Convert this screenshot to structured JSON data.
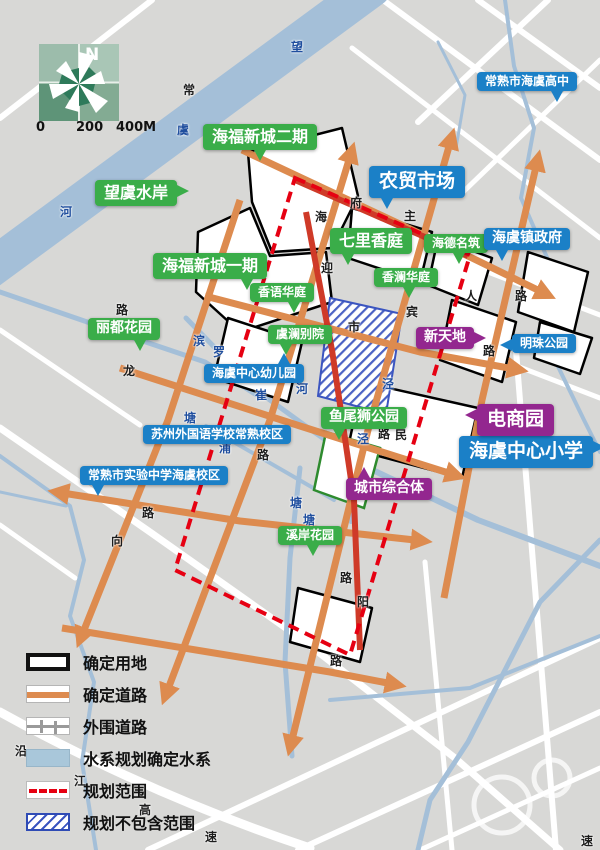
{
  "compass": {
    "north_label": "N"
  },
  "scale_bar": {
    "ticks": [
      "0",
      "200",
      "400M"
    ]
  },
  "colors": {
    "label_green": "#3aad49",
    "label_blue": "#1b80c7",
    "label_purple": "#93278f",
    "confirmed_road_orange": "#dd8b4f",
    "red_road": "#cf3a28",
    "planning_boundary_red": "#e60012",
    "water_blue": "#a4bfd8",
    "background_gray": "#d8d8d6",
    "hatch_blue": "#3b55c0"
  },
  "map_labels": [
    {
      "text": "海福新城二期",
      "color": "green",
      "x": 203,
      "y": 124,
      "size": "l",
      "tail": "b"
    },
    {
      "text": "望虞水岸",
      "color": "green",
      "x": 95,
      "y": 180,
      "size": "l",
      "tail": "r"
    },
    {
      "text": "海福新城一期",
      "color": "green",
      "x": 153,
      "y": 253,
      "size": "l",
      "tail": "br"
    },
    {
      "text": "七里香庭",
      "color": "green",
      "x": 330,
      "y": 228,
      "size": "l",
      "tail": "bl"
    },
    {
      "text": "海德名筑",
      "color": "green",
      "x": 424,
      "y": 234,
      "size": "s",
      "tail": "b"
    },
    {
      "text": "香语华庭",
      "color": "green",
      "x": 250,
      "y": 283,
      "size": "s",
      "tail": "br"
    },
    {
      "text": "香澜华庭",
      "color": "green",
      "x": 374,
      "y": 268,
      "size": "s",
      "tail": "b"
    },
    {
      "text": "丽都花园",
      "color": "green",
      "x": 88,
      "y": 318,
      "size": "m",
      "tail": "br"
    },
    {
      "text": "虞澜别院",
      "color": "green",
      "x": 268,
      "y": 325,
      "size": "s",
      "tail": "bl"
    },
    {
      "text": "鱼尾狮公园",
      "color": "green",
      "x": 321,
      "y": 407,
      "size": "m",
      "tail": "bl"
    },
    {
      "text": "溪岸花园",
      "color": "green",
      "x": 278,
      "y": 526,
      "size": "s",
      "tail": "b"
    },
    {
      "text": "常熟市海虞高中",
      "color": "blue",
      "x": 477,
      "y": 72,
      "size": "s",
      "tail": "br"
    },
    {
      "text": "农贸市场",
      "color": "blue",
      "x": 369,
      "y": 166,
      "size": "xl",
      "tail": "bl"
    },
    {
      "text": "海虞镇政府",
      "color": "blue",
      "x": 484,
      "y": 228,
      "size": "m",
      "tail": "bl"
    },
    {
      "text": "明珠公园",
      "color": "blue",
      "x": 512,
      "y": 334,
      "size": "s",
      "tail": "l"
    },
    {
      "text": "海虞中心幼儿园",
      "color": "blue",
      "x": 204,
      "y": 364,
      "size": "s",
      "tail": "tr"
    },
    {
      "text": "苏州外国语学校常熟校区",
      "color": "blue",
      "x": 143,
      "y": 425,
      "size": "s",
      "tail": "none"
    },
    {
      "text": "常熟市实验中学海虞校区",
      "color": "blue",
      "x": 80,
      "y": 466,
      "size": "s",
      "tail": "bl"
    },
    {
      "text": "海虞中心小学",
      "color": "blue",
      "x": 459,
      "y": 436,
      "size": "xl",
      "tail": "r"
    },
    {
      "text": "新天地",
      "color": "purple",
      "x": 416,
      "y": 327,
      "size": "m",
      "tail": "r"
    },
    {
      "text": "电商园",
      "color": "purple",
      "x": 477,
      "y": 404,
      "size": "xl",
      "tail": "l"
    },
    {
      "text": "城市综合体",
      "color": "purple",
      "x": 346,
      "y": 478,
      "size": "m",
      "tail": "tl"
    }
  ],
  "road_names": [
    {
      "text": "望",
      "x": 291,
      "y": 41,
      "tone": "blue"
    },
    {
      "text": "常",
      "x": 183,
      "y": 84,
      "tone": "dark"
    },
    {
      "text": "虞",
      "x": 177,
      "y": 124,
      "tone": "blue"
    },
    {
      "text": "河",
      "x": 60,
      "y": 206,
      "tone": "blue"
    },
    {
      "text": "府",
      "x": 350,
      "y": 197,
      "tone": "dark"
    },
    {
      "text": "主",
      "x": 404,
      "y": 210,
      "tone": "dark"
    },
    {
      "text": "海",
      "x": 315,
      "y": 211,
      "tone": "dark"
    },
    {
      "text": "迎",
      "x": 321,
      "y": 262,
      "tone": "dark"
    },
    {
      "text": "宾",
      "x": 406,
      "y": 306,
      "tone": "dark"
    },
    {
      "text": "人",
      "x": 465,
      "y": 290,
      "tone": "dark"
    },
    {
      "text": "路",
      "x": 515,
      "y": 290,
      "tone": "dark"
    },
    {
      "text": "市",
      "x": 348,
      "y": 321,
      "tone": "dark"
    },
    {
      "text": "滨",
      "x": 193,
      "y": 335,
      "tone": "blue"
    },
    {
      "text": "罗",
      "x": 213,
      "y": 346,
      "tone": "blue"
    },
    {
      "text": "崔",
      "x": 255,
      "y": 389,
      "tone": "blue"
    },
    {
      "text": "河",
      "x": 296,
      "y": 383,
      "tone": "blue"
    },
    {
      "text": "泾",
      "x": 382,
      "y": 378,
      "tone": "blue"
    },
    {
      "text": "塘",
      "x": 184,
      "y": 412,
      "tone": "blue"
    },
    {
      "text": "路",
      "x": 116,
      "y": 304,
      "tone": "dark"
    },
    {
      "text": "龙",
      "x": 123,
      "y": 365,
      "tone": "dark"
    },
    {
      "text": "浦",
      "x": 219,
      "y": 442,
      "tone": "blue"
    },
    {
      "text": "路",
      "x": 257,
      "y": 449,
      "tone": "dark"
    },
    {
      "text": "泾",
      "x": 357,
      "y": 433,
      "tone": "blue"
    },
    {
      "text": "路",
      "x": 378,
      "y": 428,
      "tone": "dark"
    },
    {
      "text": "民",
      "x": 395,
      "y": 429,
      "tone": "dark"
    },
    {
      "text": "路",
      "x": 483,
      "y": 345,
      "tone": "dark"
    },
    {
      "text": "路",
      "x": 142,
      "y": 507,
      "tone": "dark"
    },
    {
      "text": "向",
      "x": 111,
      "y": 535,
      "tone": "dark"
    },
    {
      "text": "塘",
      "x": 290,
      "y": 497,
      "tone": "blue"
    },
    {
      "text": "塘",
      "x": 303,
      "y": 514,
      "tone": "blue"
    },
    {
      "text": "路",
      "x": 340,
      "y": 572,
      "tone": "dark"
    },
    {
      "text": "阳",
      "x": 357,
      "y": 596,
      "tone": "dark"
    },
    {
      "text": "路",
      "x": 330,
      "y": 655,
      "tone": "dark"
    },
    {
      "text": "沿",
      "x": 15,
      "y": 745,
      "tone": "dark"
    },
    {
      "text": "江",
      "x": 74,
      "y": 775,
      "tone": "dark"
    },
    {
      "text": "高",
      "x": 139,
      "y": 804,
      "tone": "dark"
    },
    {
      "text": "速",
      "x": 205,
      "y": 831,
      "tone": "dark"
    },
    {
      "text": "速",
      "x": 581,
      "y": 835,
      "tone": "dark"
    }
  ],
  "legend": {
    "items": [
      {
        "key": "parcel",
        "label": "确定用地"
      },
      {
        "key": "road",
        "label": "确定道路"
      },
      {
        "key": "outer",
        "label": "外围道路"
      },
      {
        "key": "water",
        "label": "水系规划确定水系"
      },
      {
        "key": "range",
        "label": "规划范围"
      },
      {
        "key": "excluded",
        "label": "规划不包含范围"
      }
    ]
  }
}
